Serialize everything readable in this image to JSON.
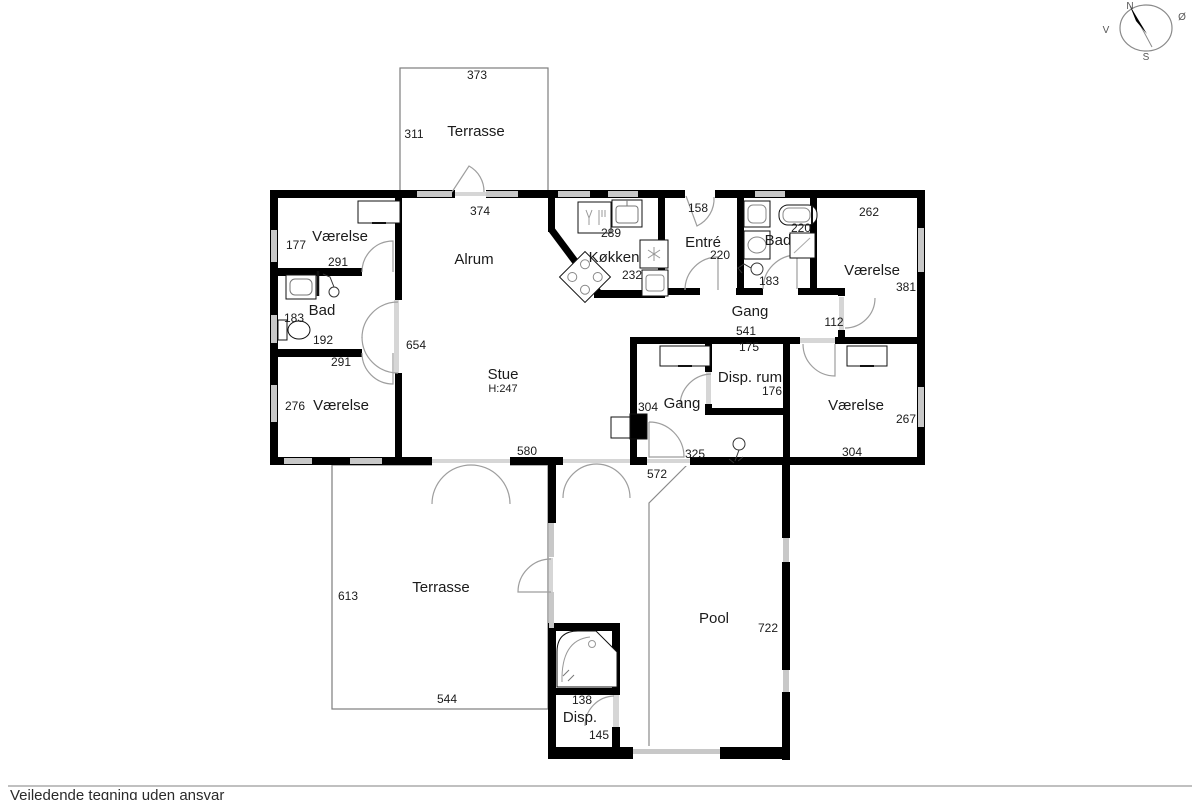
{
  "footer": {
    "disclaimer": "Vejledende tegning uden ansvar"
  },
  "compass": {
    "north": "N",
    "east": "Ø",
    "south": "S",
    "west": "V"
  },
  "colors": {
    "wall": "#000000",
    "window": "#c8c8c8",
    "door_arc": "#9e9e9e",
    "outline": "#7d7d7d"
  },
  "plan": {
    "terrasse_top": {
      "name": "Terrasse",
      "width": "373",
      "depth": "311",
      "inner_width": "374"
    },
    "alrum": {
      "name": "Alrum"
    },
    "stue": {
      "name": "Stue",
      "height_note": "H:247",
      "width": "580",
      "depth": "654"
    },
    "vaerelse_nw": {
      "name": "Værelse",
      "depth": "177",
      "width": "291"
    },
    "bad_w": {
      "name": "Bad",
      "depth": "183",
      "width": "192"
    },
    "vaerelse_w": {
      "name": "Værelse",
      "width": "291",
      "depth": "276"
    },
    "koekken": {
      "name": "Køkken",
      "width": "289",
      "depth": "232"
    },
    "entre": {
      "name": "Entré",
      "door_width": "158",
      "width": "220"
    },
    "bad_e": {
      "name": "Bad",
      "width": "220",
      "depth": "183"
    },
    "vaerelse_ne": {
      "name": "Værelse",
      "width": "262",
      "depth": "381"
    },
    "gang_n": {
      "name": "Gang",
      "length": "541",
      "stub": "112",
      "opening": "175"
    },
    "disp_rum": {
      "name": "Disp. rum",
      "width": "176"
    },
    "gang_s": {
      "name": "Gang",
      "depth": "304",
      "width": "325",
      "leader": "572"
    },
    "vaerelse_se": {
      "name": "Værelse",
      "depth": "267",
      "width": "304"
    },
    "terrasse_s": {
      "name": "Terrasse",
      "depth": "613",
      "width": "544"
    },
    "pool": {
      "name": "Pool",
      "depth": "722"
    },
    "spa_disp": {
      "name": "Disp.",
      "width": "138",
      "depth": "145"
    }
  }
}
